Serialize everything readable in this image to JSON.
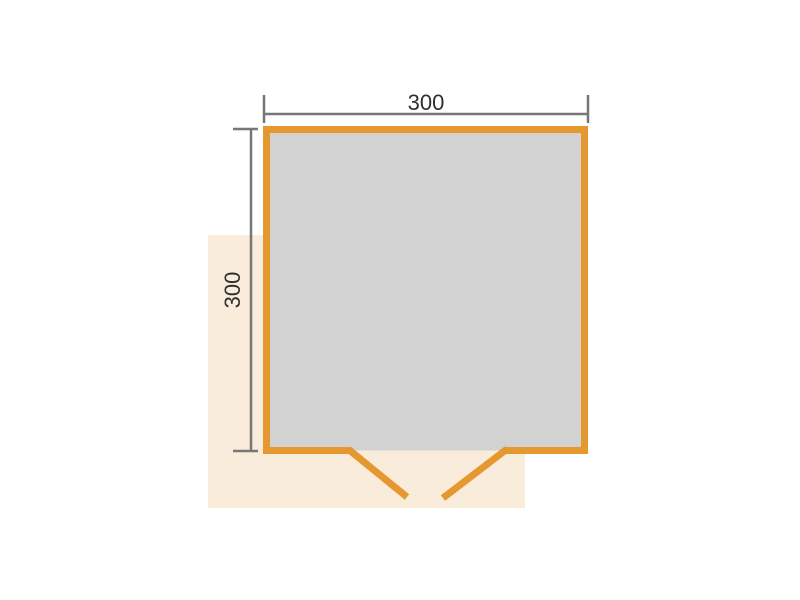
{
  "diagram": {
    "dimensions": {
      "width_label": "300",
      "depth_label": "300"
    },
    "colors": {
      "wall": "#E5982F",
      "interior": "#D2D2D2",
      "base": "#F9ECDB",
      "dimension_line": "#777777",
      "label_text": "#2F2F2F",
      "background": "#FFFFFF"
    }
  }
}
